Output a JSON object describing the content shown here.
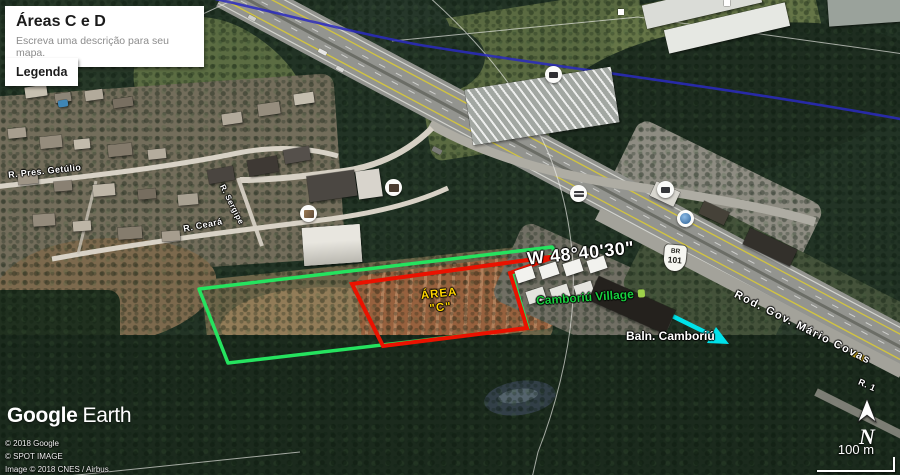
{
  "panel": {
    "title": "Áreas C e D",
    "subtitle": "Escreva uma descrição para seu mapa."
  },
  "legend": {
    "label": "Legenda"
  },
  "map_labels": {
    "coordinate": "W 48°40'30\"",
    "area_line1": "ÁREA",
    "area_line2": "\"C\"",
    "village": "Camboriú Village",
    "destination": "Baln. Camboriú"
  },
  "roads": {
    "pres_getulio": "R. Pres. Getúlio",
    "ceara": "R. Ceará",
    "sergipe": "R. Sergipe",
    "mario_covas": "Rod. Gov. Mário Covas",
    "r1": "R. 1",
    "shield_top": "BR",
    "shield_num": "101"
  },
  "attribution": {
    "logo_word1": "Google",
    "logo_word2": "Earth",
    "line1": "© 2018 Google",
    "line2": "© SPOT IMAGE",
    "line3": "Image © 2018 CNES / Airbus"
  },
  "navigation": {
    "north_label": "N",
    "scale_label": "100 m"
  },
  "annotation_colors": {
    "area_c_stroke": "#ea1200",
    "area_d_stroke": "#25e35f",
    "area_label_yellow": "#ffd400",
    "village_green": "#17cf3d",
    "arrow_cyan": "#00e2ea",
    "grid_blue": "#2a2ac0"
  }
}
